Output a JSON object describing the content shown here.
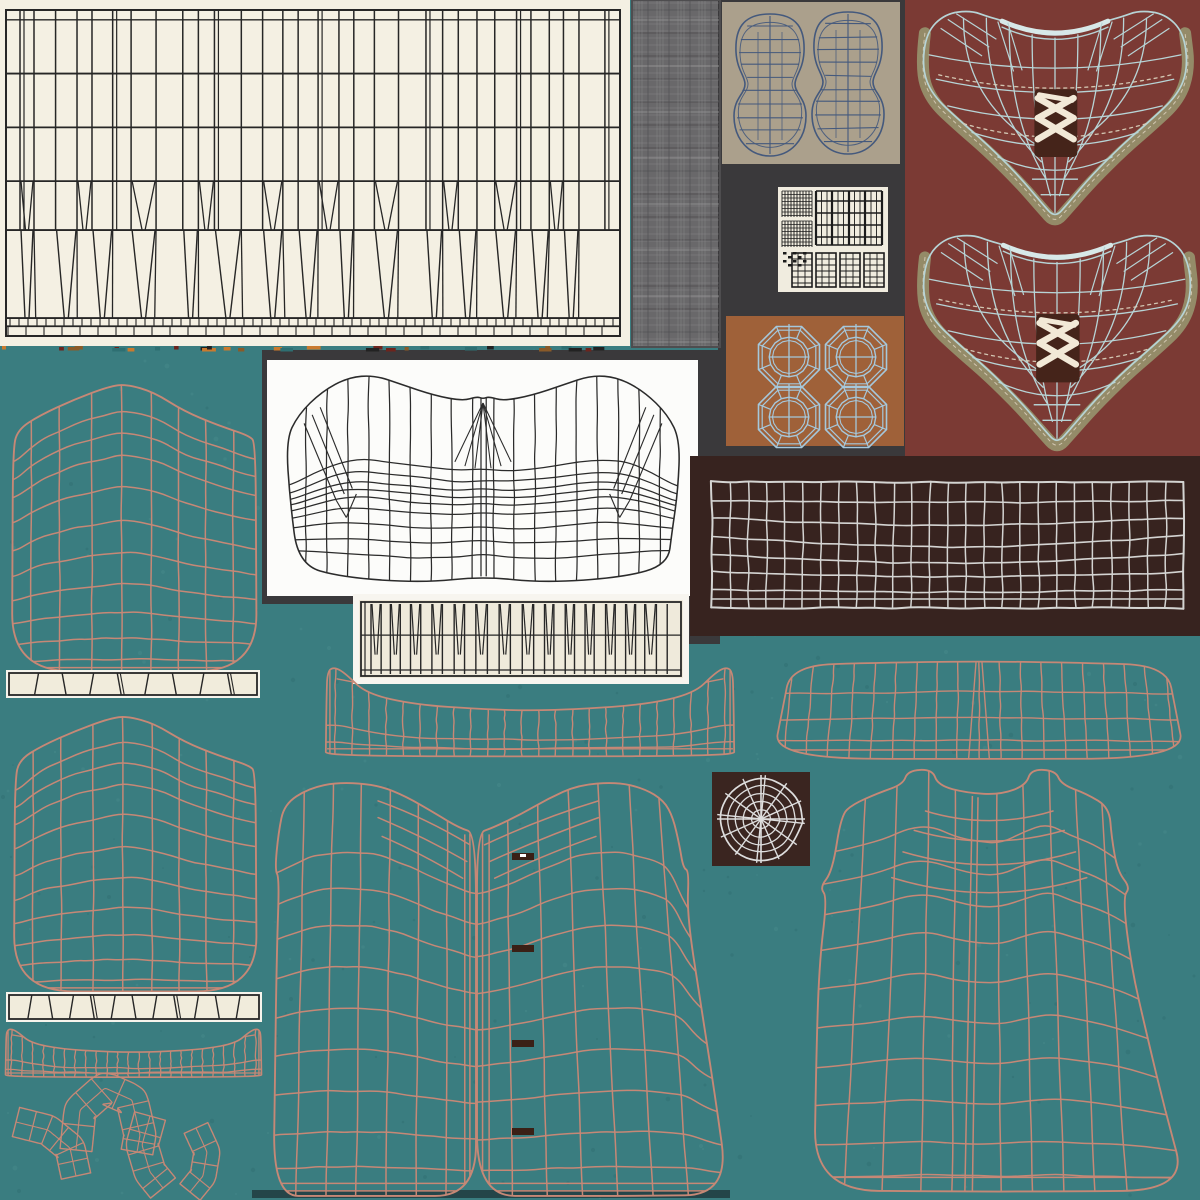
{
  "canvas": {
    "width": 1200,
    "height": 1200,
    "background": "#3a7d80"
  },
  "palette": {
    "teal_bg": "#3a7d80",
    "teal_dot_light": "#4d8e90",
    "teal_dot_dark": "#2e6b6e",
    "cream_panel": "#f4f0e3",
    "panel_line_dark": "#262626",
    "crosshatch_base": "#69686a",
    "crosshatch_light": "#989798",
    "crosshatch_dark": "#4e4d4f",
    "dark_backdrop": "#3a393b",
    "sole_bg": "#aba08c",
    "sole_line": "#44597d",
    "plaid_bg": "#f0ecdf",
    "plaid_line": "#1b1b1b",
    "octagon_bg": "#9f6139",
    "octagon_line": "#a5c8dc",
    "vest_bg": "#7b3a34",
    "vest_line": "#b7d4d6",
    "vest_line_soft": "#d7e8e8",
    "vest_band": "#948b68",
    "vest_stitch": "#d8cdb9",
    "lace_white": "#f2e9d7",
    "lace_bg": "#45241a",
    "waistband_bg": "#37231f",
    "waistband_line": "#d4d4d2",
    "corset_bg": "#fcfcfa",
    "corset_line": "#2b2b2b",
    "pleat_outer": "#f7f5ef",
    "pleat_bg": "#efeadb",
    "salmon_line": "#c68876",
    "cuff_outer": "#f6f4ec",
    "cuff_bg": "#f1ecdc",
    "web_bg": "#3a2520",
    "web_line": "#dedede",
    "buttonhole": "#3a2016",
    "button_glint": "#ffffff",
    "hem_shadow": "#1d3337",
    "seam_colors": [
      "#c97a2e",
      "#6e241c",
      "#2e6f72",
      "#8a5a28",
      "#222222"
    ]
  },
  "panels": [
    {
      "name": "panel-cream-large",
      "x": 0,
      "y": 0,
      "w": 630,
      "h": 346,
      "fill": "cream_panel"
    },
    {
      "name": "panel-crosshatch-base",
      "x": 632,
      "y": 0,
      "w": 88,
      "h": 347,
      "fill": "crosshatch_base"
    },
    {
      "name": "panel-dark-right",
      "x": 718,
      "y": 0,
      "w": 190,
      "h": 458,
      "fill": "dark_backdrop"
    },
    {
      "name": "panel-sole",
      "x": 722,
      "y": 2,
      "w": 178,
      "h": 162,
      "fill": "sole_bg"
    },
    {
      "name": "panel-plaid",
      "x": 778,
      "y": 187,
      "w": 110,
      "h": 105,
      "fill": "plaid_bg"
    },
    {
      "name": "panel-octagon",
      "x": 726,
      "y": 316,
      "w": 178,
      "h": 130,
      "fill": "octagon_bg"
    },
    {
      "name": "panel-vest",
      "x": 905,
      "y": 0,
      "w": 295,
      "h": 456,
      "fill": "vest_bg"
    },
    {
      "name": "panel-dark-mid",
      "x": 262,
      "y": 350,
      "w": 458,
      "h": 254,
      "fill": "dark_backdrop"
    },
    {
      "name": "panel-dark-notch",
      "x": 678,
      "y": 596,
      "w": 42,
      "h": 48,
      "fill": "dark_backdrop"
    },
    {
      "name": "panel-corset",
      "x": 267,
      "y": 360,
      "w": 431,
      "h": 236,
      "fill": "corset_bg"
    },
    {
      "name": "panel-waistband",
      "x": 690,
      "y": 456,
      "w": 510,
      "h": 180,
      "fill": "waistband_bg"
    },
    {
      "name": "panel-pleat-small-outer",
      "x": 353,
      "y": 594,
      "w": 336,
      "h": 90,
      "fill": "pleat_outer"
    },
    {
      "name": "panel-pleat-small-inner",
      "x": 359,
      "y": 600,
      "w": 324,
      "h": 78,
      "fill": "pleat_bg"
    },
    {
      "name": "panel-web",
      "x": 712,
      "y": 772,
      "w": 98,
      "h": 94,
      "fill": "web_bg"
    }
  ],
  "pieces": [
    {
      "name": "pleat-panel-large",
      "kind": "pleatPanel",
      "x": 0,
      "y": 0,
      "w": 630,
      "h": 346,
      "stroke": "panel_line_dark"
    },
    {
      "name": "seam-strip",
      "kind": "seam",
      "x": 2,
      "y": 345,
      "w": 626,
      "h": 9
    },
    {
      "name": "fabric-crosshatch",
      "kind": "crosshatch",
      "x": 632,
      "y": 0,
      "w": 88,
      "h": 347
    },
    {
      "name": "sole-wireframes",
      "kind": "soles",
      "x": 722,
      "y": 2,
      "w": 178,
      "h": 162,
      "stroke": "sole_line"
    },
    {
      "name": "plaid-swatch",
      "kind": "plaid",
      "x": 778,
      "y": 187,
      "w": 110,
      "h": 105,
      "stroke": "plaid_line"
    },
    {
      "name": "octagon-buttons",
      "kind": "octagons",
      "x": 726,
      "y": 316,
      "w": 178,
      "h": 130,
      "stroke": "octagon_line"
    },
    {
      "name": "vest-front-upper",
      "kind": "vest",
      "x": 912,
      "y": 6,
      "w": 286,
      "h": 222
    },
    {
      "name": "vest-front-lower",
      "kind": "vest",
      "x": 912,
      "y": 230,
      "w": 290,
      "h": 224
    },
    {
      "name": "corset-wireframe",
      "kind": "mesh",
      "geo": "corset",
      "x": 282,
      "y": 372,
      "w": 402,
      "h": 214,
      "stroke": "corset_line",
      "lw": 1.25
    },
    {
      "name": "waistband-grid",
      "kind": "wavyGrid",
      "x": 712,
      "y": 482,
      "w": 472,
      "h": 126,
      "stroke": "waistband_line"
    },
    {
      "name": "pleat-strip-small",
      "kind": "pleatStrip",
      "x": 359,
      "y": 600,
      "w": 324,
      "h": 78,
      "stroke": "panel_line_dark"
    },
    {
      "name": "spider-web",
      "kind": "web",
      "x": 712,
      "y": 772,
      "w": 98,
      "h": 94,
      "stroke": "web_line"
    },
    {
      "name": "sleeve-upper",
      "kind": "mesh",
      "geo": "sleeve",
      "x": 10,
      "y": 382,
      "w": 248,
      "h": 290,
      "stroke": "salmon_line",
      "lw": 1.5
    },
    {
      "name": "cuff-strip-upper",
      "kind": "cuff",
      "x": 6,
      "y": 670,
      "w": 254,
      "h": 28,
      "n": 9
    },
    {
      "name": "sleeve-lower",
      "kind": "mesh",
      "geo": "sleeve",
      "x": 12,
      "y": 714,
      "w": 246,
      "h": 278,
      "stroke": "salmon_line",
      "lw": 1.5
    },
    {
      "name": "cuff-strip-lower",
      "kind": "cuff",
      "x": 6,
      "y": 992,
      "w": 256,
      "h": 30,
      "n": 12
    },
    {
      "name": "collar-strip-wide",
      "kind": "mesh",
      "geo": "collar",
      "x": 325,
      "y": 666,
      "w": 410,
      "h": 92,
      "stroke": "salmon_line",
      "lw": 1.4
    },
    {
      "name": "collar-strip-narrow",
      "kind": "mesh",
      "geo": "collar",
      "x": 5,
      "y": 1028,
      "w": 257,
      "h": 50,
      "stroke": "salmon_line",
      "lw": 1.3
    },
    {
      "name": "yoke-panel",
      "kind": "mesh",
      "geo": "yoke",
      "x": 772,
      "y": 660,
      "w": 414,
      "h": 100,
      "stroke": "salmon_line",
      "lw": 1.4
    },
    {
      "name": "hem-shadow",
      "kind": "rectFill",
      "x": 252,
      "y": 1190,
      "w": 478,
      "h": 8,
      "fill": "hem_shadow",
      "opacity": 0.75
    },
    {
      "name": "shirt-front-left",
      "kind": "mesh",
      "geo": "frontL",
      "x": 272,
      "y": 780,
      "w": 204,
      "h": 418,
      "stroke": "salmon_line",
      "lw": 1.5
    },
    {
      "name": "shirt-front-right",
      "kind": "mesh",
      "geo": "frontR",
      "x": 477,
      "y": 780,
      "w": 253,
      "h": 418,
      "stroke": "salmon_line",
      "lw": 1.5
    },
    {
      "name": "shirt-back",
      "kind": "mesh",
      "geo": "back",
      "x": 813,
      "y": 768,
      "w": 375,
      "h": 430,
      "stroke": "salmon_line",
      "lw": 1.5
    },
    {
      "name": "trim-arch",
      "kind": "arcBand",
      "pts": [
        [
          76,
          1150
        ],
        [
          80,
          1110
        ],
        [
          105,
          1088
        ],
        [
          132,
          1100
        ],
        [
          140,
          1135
        ],
        [
          137,
          1152
        ]
      ],
      "hw": 16,
      "cells": 8,
      "stroke": "salmon_line"
    },
    {
      "name": "trim-corner",
      "kind": "arcBand",
      "pts": [
        [
          16,
          1122
        ],
        [
          48,
          1130
        ],
        [
          70,
          1148
        ],
        [
          76,
          1176
        ]
      ],
      "hw": 15,
      "cells": 6,
      "stroke": "salmon_line"
    },
    {
      "name": "trim-curve-a",
      "kind": "arcBand",
      "pts": [
        [
          150,
          1116
        ],
        [
          142,
          1145
        ],
        [
          150,
          1172
        ],
        [
          163,
          1188
        ]
      ],
      "hw": 16,
      "cells": 5,
      "stroke": "salmon_line"
    },
    {
      "name": "trim-curve-b",
      "kind": "arcBand",
      "pts": [
        [
          196,
          1128
        ],
        [
          207,
          1152
        ],
        [
          203,
          1176
        ],
        [
          190,
          1192
        ]
      ],
      "hw": 13,
      "cells": 4,
      "stroke": "salmon_line"
    },
    {
      "name": "buttonholes",
      "kind": "buttons",
      "items": [
        [
          512,
          853
        ],
        [
          512,
          945
        ],
        [
          512,
          1040
        ],
        [
          512,
          1128
        ]
      ],
      "w": 22,
      "h": 7,
      "fill": "buttonhole"
    }
  ]
}
